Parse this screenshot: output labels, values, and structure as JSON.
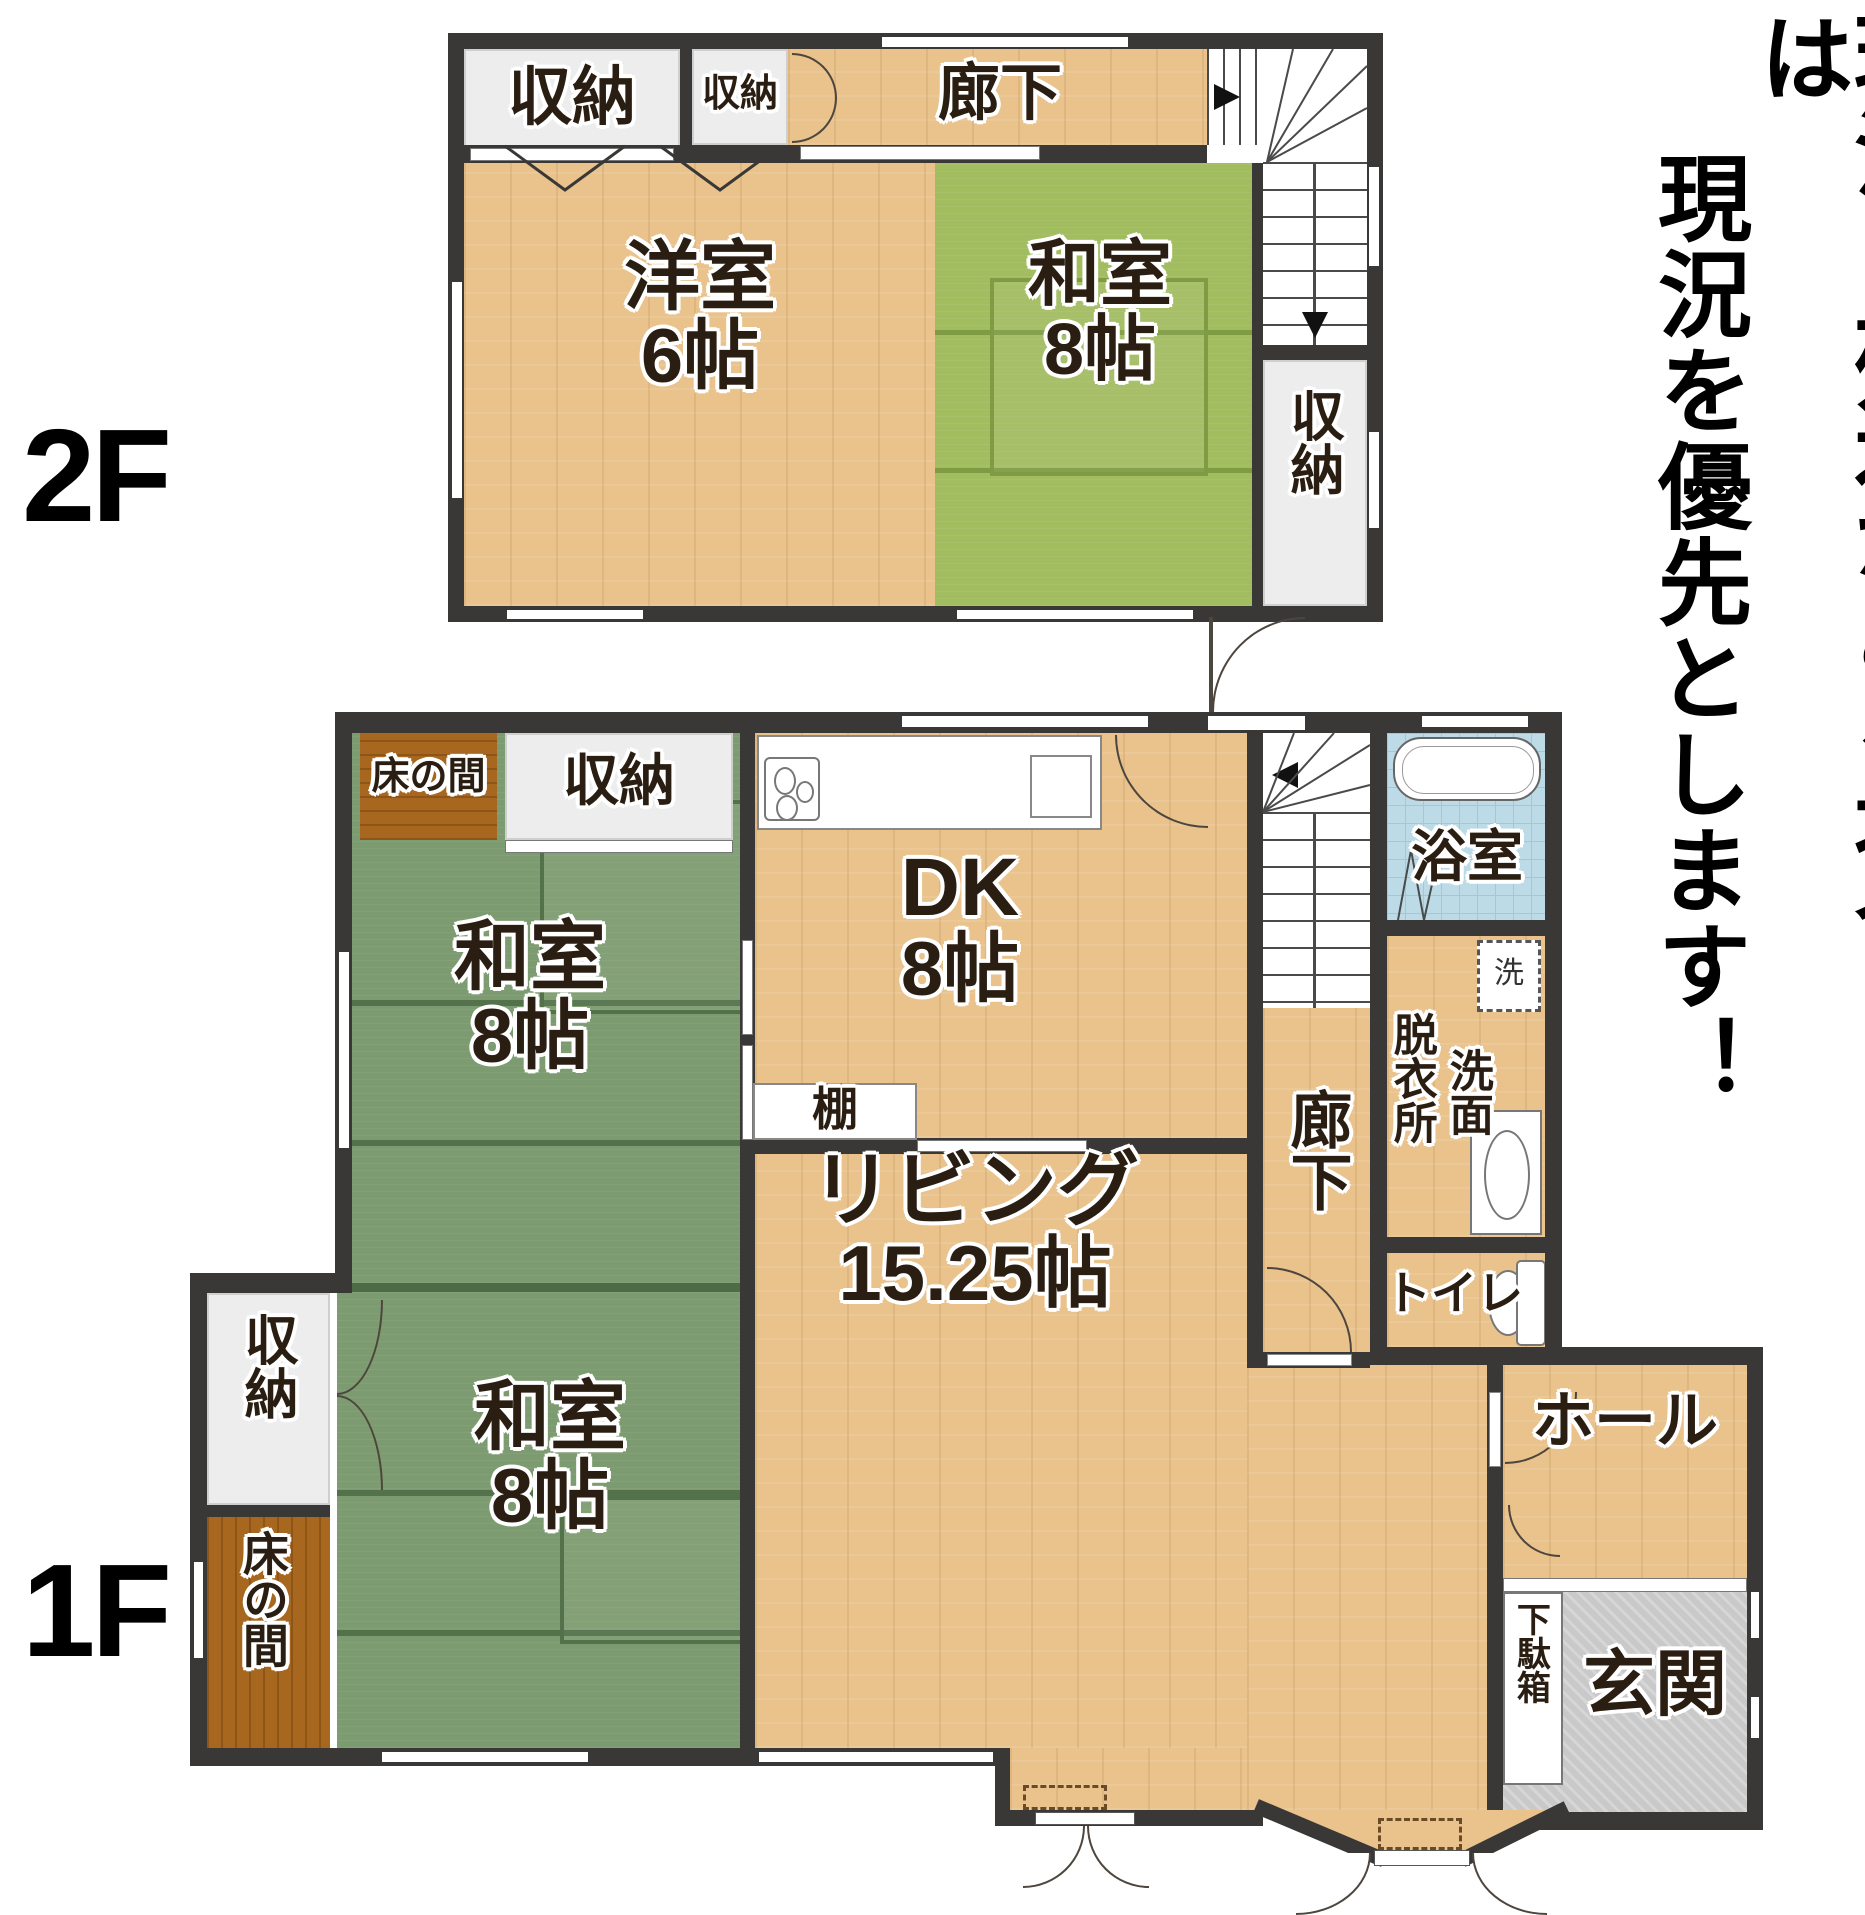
{
  "page": {
    "floor2_label": "2F",
    "floor1_label": "1F"
  },
  "disclaimer": {
    "column1": "現況と相違がある場合は",
    "column2": "現況を優先とします！"
  },
  "floor2": {
    "closet_big": "収納",
    "closet_small": "収納",
    "corridor": "廊下",
    "western_room": {
      "name": "洋室",
      "size": "6帖"
    },
    "japanese_room": {
      "name": "和室",
      "size": "8帖"
    },
    "closet_side": "収納"
  },
  "floor1": {
    "tokonoma_top": "床の間",
    "closet_top": "収納",
    "dk": {
      "name": "DK",
      "size": "8帖"
    },
    "bath": "浴室",
    "washer": "洗",
    "dressing_room": "脱衣所",
    "washroom": "洗面",
    "toilet": "トイレ",
    "corridor": "廊下",
    "shelf": "棚",
    "japanese_upper": {
      "name": "和室",
      "size": "8帖"
    },
    "closet_side": "収納",
    "tokonoma_side": "床の間",
    "japanese_lower": {
      "name": "和室",
      "size": "8帖"
    },
    "living": {
      "name": "リビング",
      "size": "15.25帖"
    },
    "hall": "ホール",
    "shoe_box": "下駄箱",
    "entrance": "玄関"
  }
}
